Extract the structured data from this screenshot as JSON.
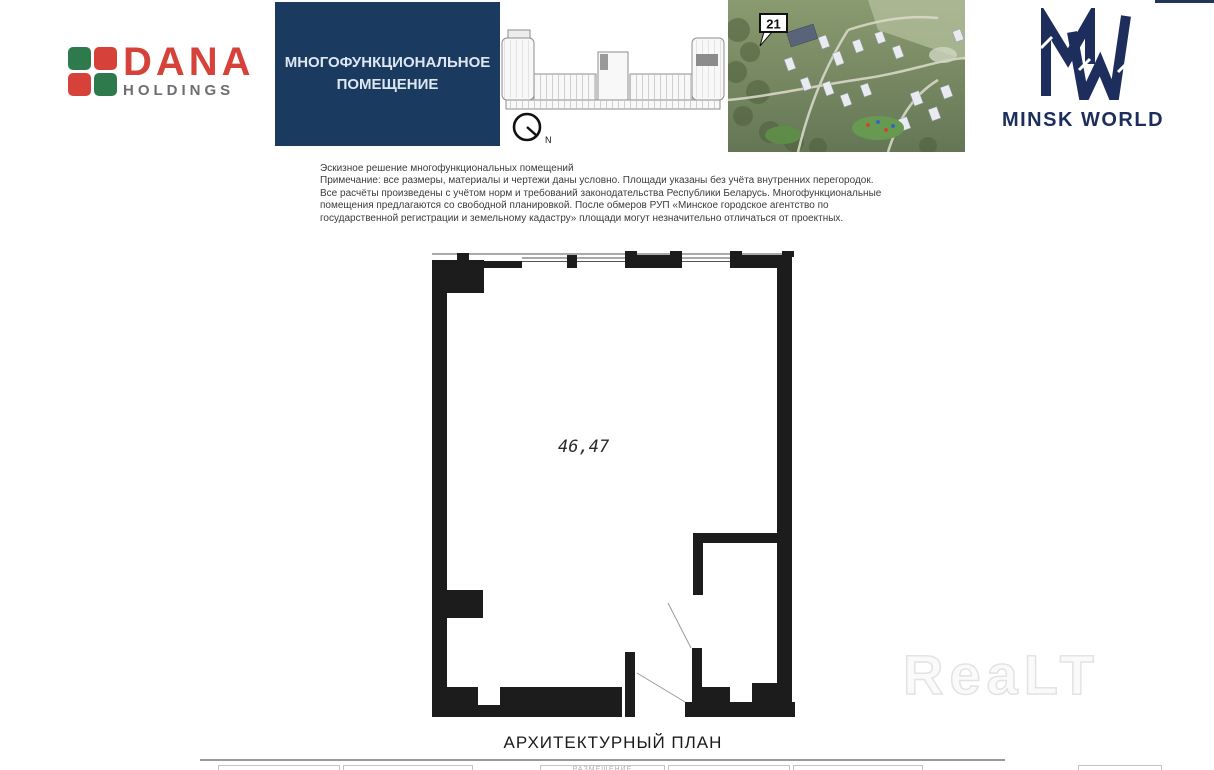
{
  "brand_dana": {
    "word": "DANA",
    "sub": "HOLDINGS",
    "green": "#2f7a4c",
    "red": "#d6413a",
    "gray": "#6d6e71"
  },
  "header_box": {
    "line1": "МНОГОФУНКЦИОНАЛЬНОЕ",
    "line2": "ПОМЕЩЕНИЕ",
    "bg": "#1a3a5f"
  },
  "compass": {
    "label": "N"
  },
  "site_photo": {
    "callout": "21"
  },
  "brand_mw": {
    "name": "MINSK WORLD",
    "navy": "#1d2d5c"
  },
  "notes": {
    "text": "Эскизное решение многофункциональных помещений\nПримечание: все размеры, материалы и чертежи даны условно. Площади указаны без учёта внутренних перегородок.\nВсе расчёты произведены с учётом норм и требований законодательства Республики Беларусь. Многофункциональные\nпомещения предлагаются со свободной планировкой. После обмеров РУП «Минское городское агентство по\nгосударственной регистрации и земельному кадастру» площади могут незначительно отличаться от проектных."
  },
  "plan": {
    "area": "46,47",
    "caption": "АРХИТЕКТУРНЫЙ ПЛАН",
    "wall_color": "#1c1c1c"
  },
  "watermark": {
    "text": "ReaLT"
  },
  "footer": {
    "faint_label": "РАЗМЕЩЕНИЕ"
  }
}
